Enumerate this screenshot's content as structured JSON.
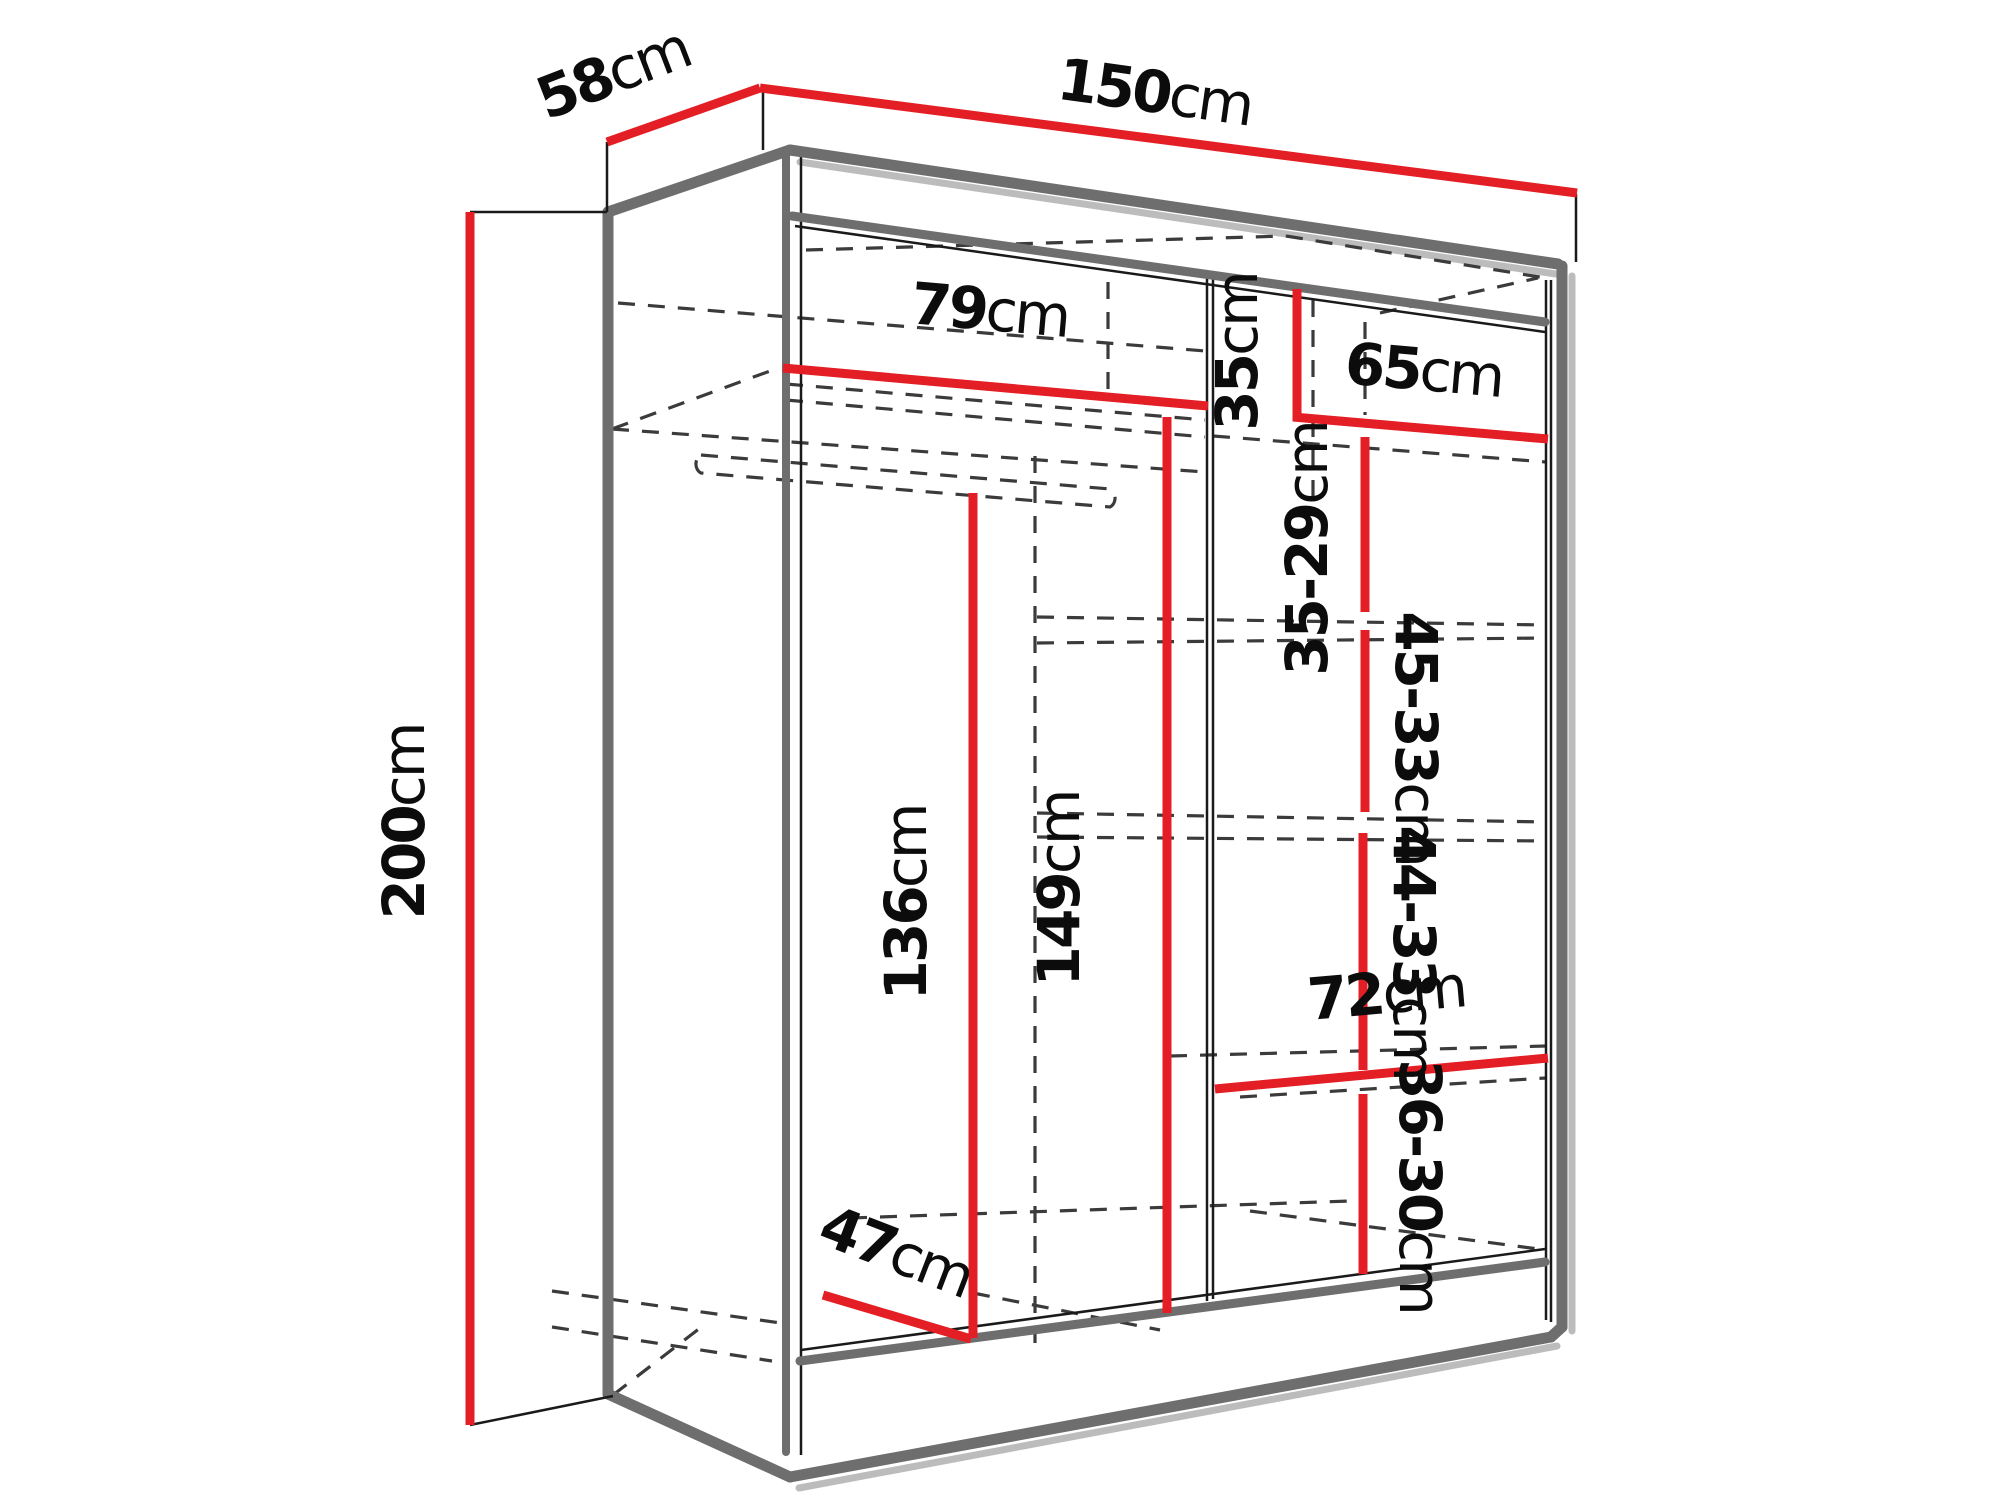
{
  "diagram": {
    "type": "wardrobe-dimension-diagram",
    "unit": "cm",
    "colors": {
      "dim": "#e31e24",
      "outline": "#6e6e6e",
      "thin": "#1a1a1a",
      "dash": "#3b3b3b",
      "shadow": "#bcbcbc",
      "bg": "#ffffff"
    },
    "dimensions": {
      "height": {
        "value": "200",
        "unit": "cm"
      },
      "depth": {
        "value": "58",
        "unit": "cm"
      },
      "width": {
        "value": "150",
        "unit": "cm"
      },
      "left_shelf_width": {
        "value": "79",
        "unit": "cm"
      },
      "top_right_height": {
        "value": "35",
        "unit": "cm"
      },
      "right_shelf_width": {
        "value": "65",
        "unit": "cm"
      },
      "right_gap_1": {
        "value": "35-29",
        "unit": "cm"
      },
      "right_gap_2": {
        "value": "45-33",
        "unit": "cm"
      },
      "right_gap_3": {
        "value": "44-33",
        "unit": "cm"
      },
      "bottom_shelf_width": {
        "value": "72",
        "unit": "cm"
      },
      "right_gap_4": {
        "value": "36-30",
        "unit": "cm"
      },
      "hanging_height": {
        "value": "136",
        "unit": "cm"
      },
      "interior_height": {
        "value": "149",
        "unit": "cm"
      },
      "bottom_depth": {
        "value": "47",
        "unit": "cm"
      }
    }
  }
}
